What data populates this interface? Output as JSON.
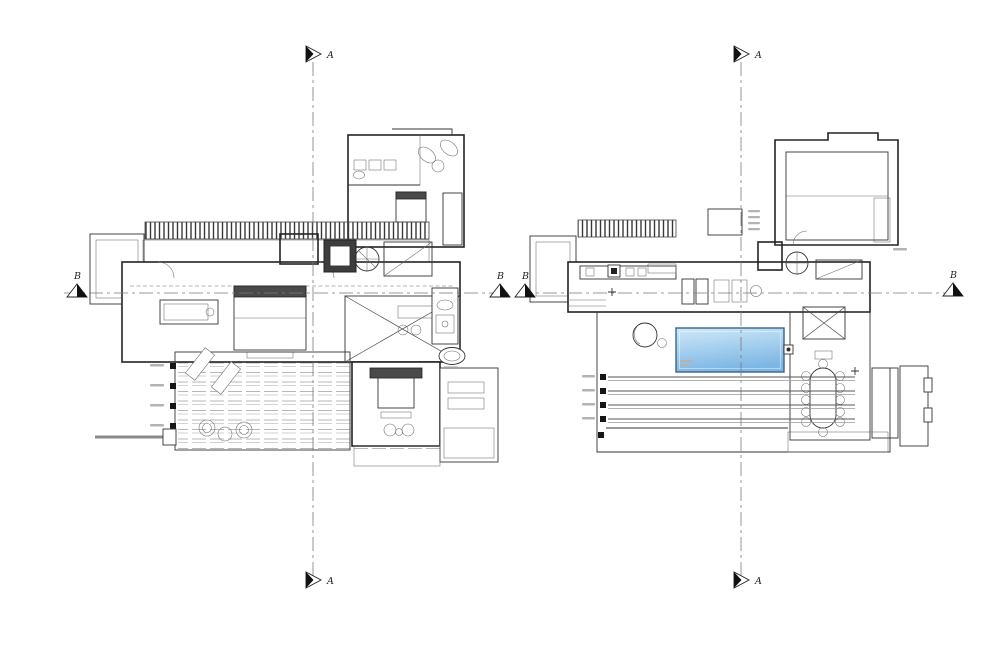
{
  "drawing": {
    "kind": "architectural floor plans, two levels side by side",
    "section_labels": {
      "a": "A",
      "b": "B"
    },
    "colors": {
      "background": "#ffffff",
      "line": "#2b2b2b",
      "line_light": "#9a9a9a",
      "pool_light": "#cfe9f9",
      "pool_dark": "#7db6e4",
      "pool_edge": "#38648f"
    }
  }
}
